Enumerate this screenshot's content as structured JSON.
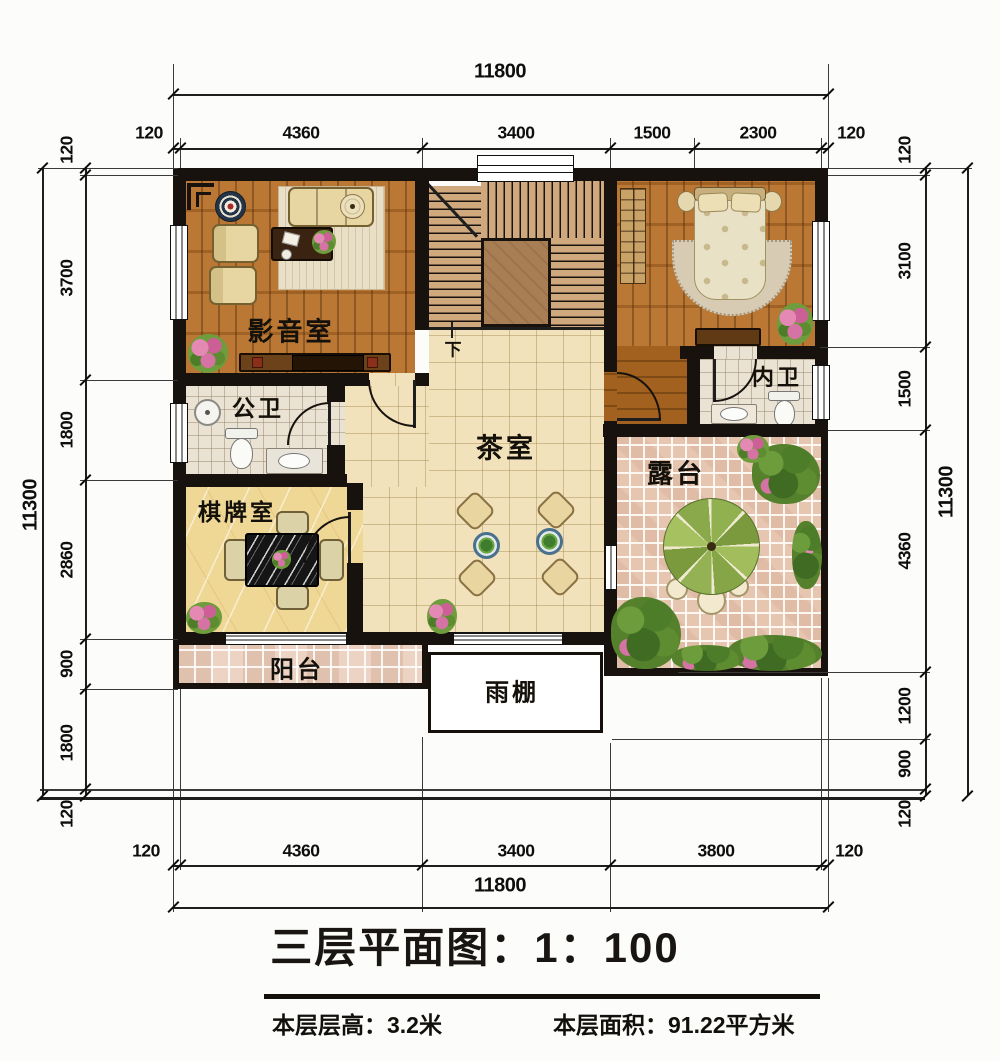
{
  "title": {
    "text": "三层平面图：1：100"
  },
  "footer": {
    "floor_height": "本层层高：3.2米",
    "floor_area": "本层面积：91.22平方米"
  },
  "rooms": {
    "media_room": "影音室",
    "public_bath": "公卫",
    "chess_room": "棋牌室",
    "tea_room": "茶室",
    "ensuite_bath": "内卫",
    "terrace": "露台",
    "balcony": "阳台",
    "rain_canopy": "雨棚",
    "stair_direction": "下"
  },
  "dimensions": {
    "top": {
      "overall": "11800",
      "segments": [
        "120",
        "4360",
        "3400",
        "1500",
        "2300",
        "120"
      ]
    },
    "bottom": {
      "overall": "11800",
      "segments": [
        "120",
        "4360",
        "3400",
        "3800",
        "120"
      ]
    },
    "left": {
      "overall": "11300",
      "segments": [
        "120",
        "3700",
        "1800",
        "2860",
        "900",
        "1800",
        "120"
      ]
    },
    "right": {
      "overall": "11300",
      "segments": [
        "120",
        "3100",
        "1500",
        "4360",
        "1200",
        "900",
        "120"
      ]
    }
  },
  "colors": {
    "wall": "#17120d",
    "wood_floor": "#b06d2a",
    "tea_tile": "#f2e2bb",
    "bath_tile": "#eae2d2",
    "chess_floor": "#efd795",
    "balcony_tile": "#ecd3c4",
    "terrace_tile": "#e6c6b1",
    "stair_tread": "#d0a87e",
    "parasol_green": "#8fae4e",
    "plant_green": "#4e7d2a",
    "flower_pink": "#d473a4"
  }
}
